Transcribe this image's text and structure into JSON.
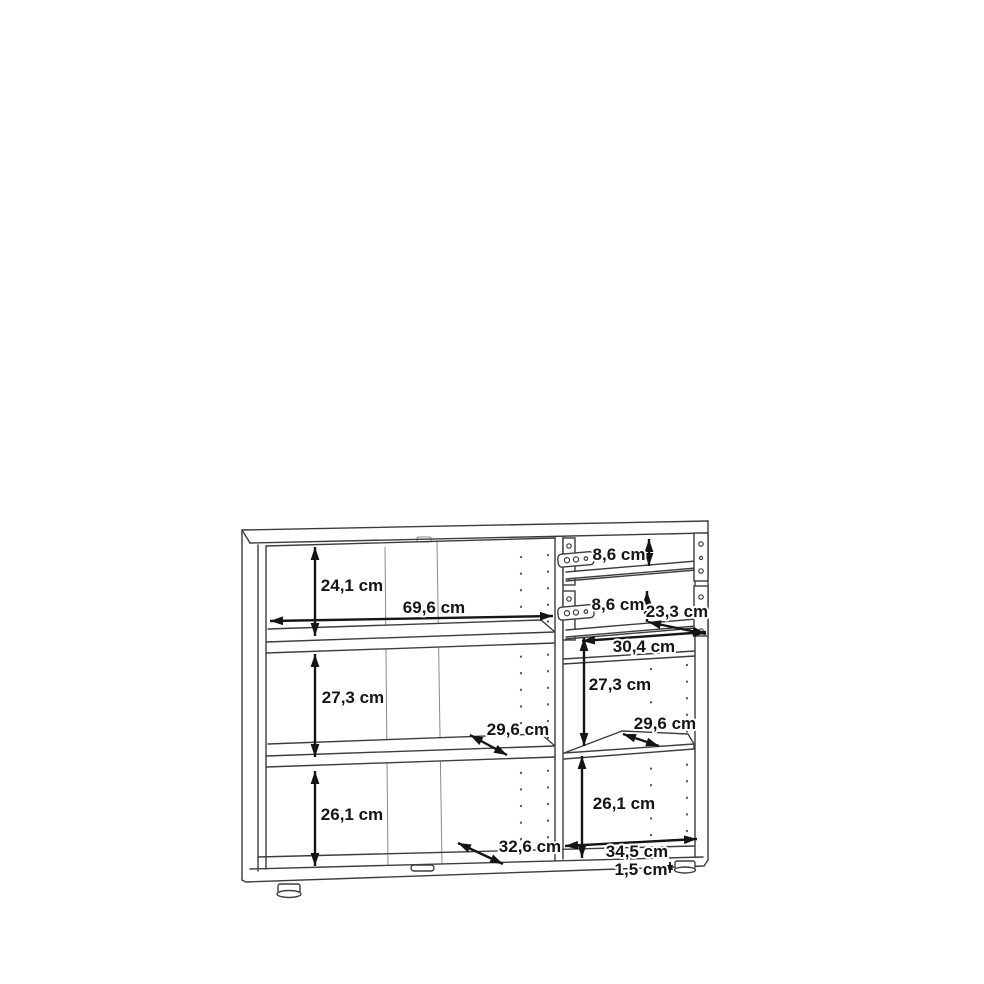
{
  "diagram": {
    "dimension_labels": {
      "left_top_section_height": "24,1 cm",
      "left_interior_width": "69,6 cm",
      "top_drawer_height": "8,6 cm",
      "second_drawer_height": "8,6 cm",
      "drawer_interior_depth": "23,3 cm",
      "drawer_interior_width": "30,4 cm",
      "left_middle_section_height": "27,3 cm",
      "right_middle_section_height": "27,3 cm",
      "left_shelf_depth": "29,6 cm",
      "right_shelf_depth": "29,6 cm",
      "left_bottom_section_height": "26,1 cm",
      "right_bottom_section_height": "26,1 cm",
      "bottom_interior_depth": "32,6 cm",
      "right_interior_width": "34,5 cm",
      "plinth_height": "1,5 cm"
    }
  }
}
